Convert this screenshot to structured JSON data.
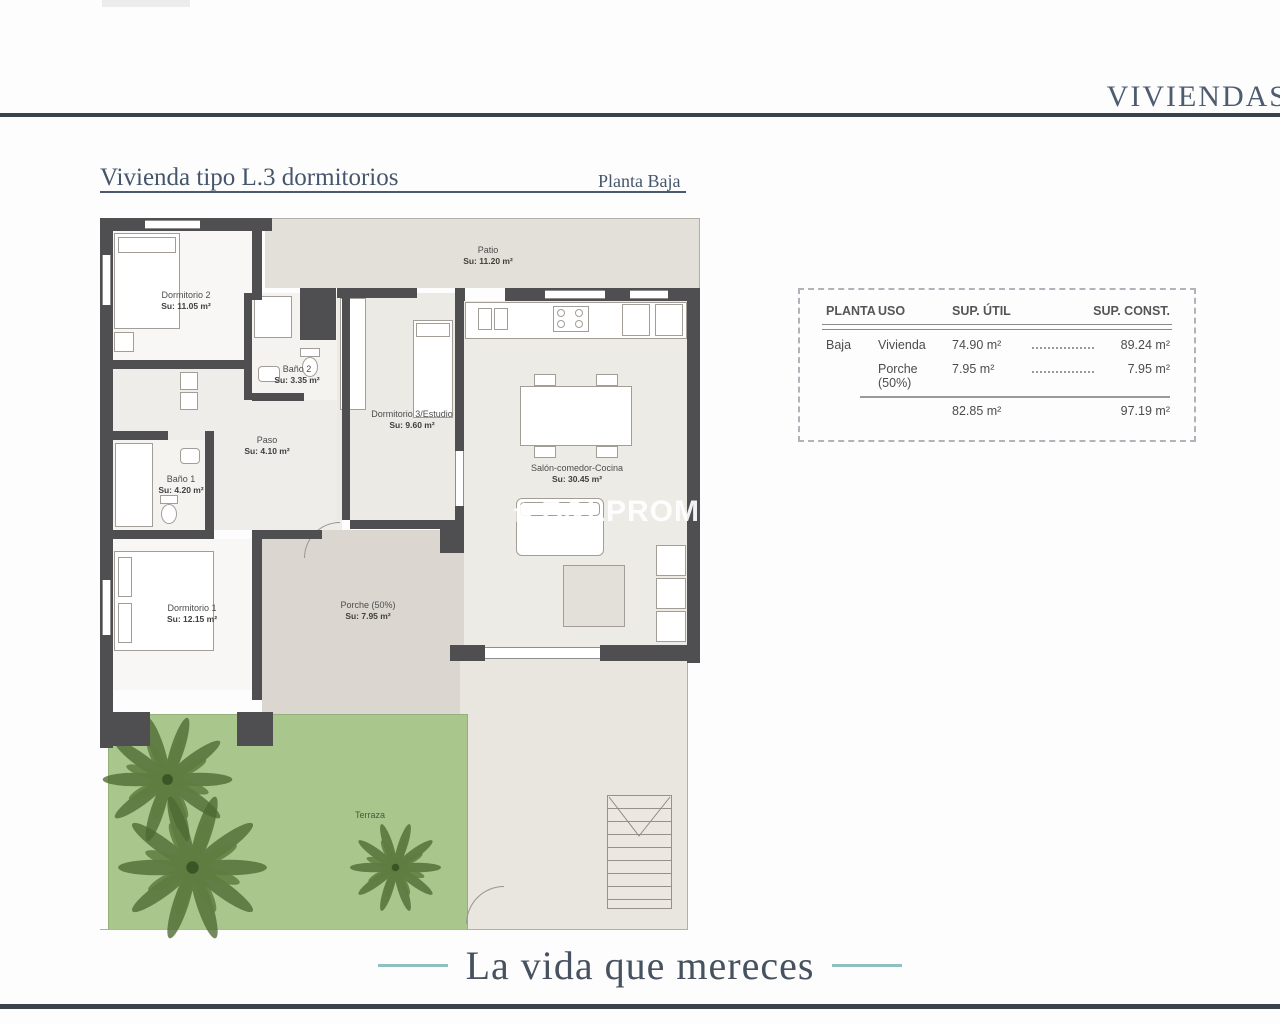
{
  "header": {
    "brand": "VIVIENDAS"
  },
  "plan": {
    "title": "Vivienda tipo L.3 dormitorios",
    "floor_label": "Planta Baja"
  },
  "rooms": {
    "patio": {
      "name": "Patio",
      "area": "Su: 11.20 m²"
    },
    "dormitorio2": {
      "name": "Dormitorio 2",
      "area": "Su: 11.05 m²"
    },
    "bano2": {
      "name": "Baño 2",
      "area": "Su: 3.35 m²"
    },
    "dormitorio3": {
      "name": "Dormitorio 3/Estudio",
      "area": "Su: 9.60 m²"
    },
    "paso": {
      "name": "Paso",
      "area": "Su: 4.10 m²"
    },
    "bano1": {
      "name": "Baño 1",
      "area": "Su: 4.20 m²"
    },
    "salon": {
      "name": "Salón-comedor-Cocina",
      "area": "Su: 30.45 m²"
    },
    "dormitorio1": {
      "name": "Dormitorio 1",
      "area": "Su: 12.15 m²"
    },
    "porche": {
      "name": "Porche (50%)",
      "area": "Su: 7.95 m²"
    },
    "terraza": {
      "name": "Terraza"
    }
  },
  "surface_table": {
    "headers": {
      "planta": "PLANTA",
      "uso": "USO",
      "sup_util": "SUP. ÚTIL",
      "sup_const": "SUP. CONST."
    },
    "rows": [
      {
        "planta": "Baja",
        "uso": "Vivienda",
        "sup_util": "74.90 m²",
        "sup_const": "89.24 m²"
      },
      {
        "planta": "",
        "uso": "Porche (50%)",
        "sup_util": "7.95 m²",
        "sup_const": "7.95 m²"
      }
    ],
    "totals": {
      "sup_util": "82.85 m²",
      "sup_const": "97.19 m²"
    }
  },
  "watermark": {
    "text": "B&LPROM"
  },
  "footer": {
    "tagline": "La vida que mereces"
  },
  "colors": {
    "navy_rule": "#39434e",
    "teal_accent": "#8fc0c2",
    "heading_blue": "#45566c",
    "wall_dark": "#4f4f52",
    "garden_green": "#a9c68c"
  }
}
